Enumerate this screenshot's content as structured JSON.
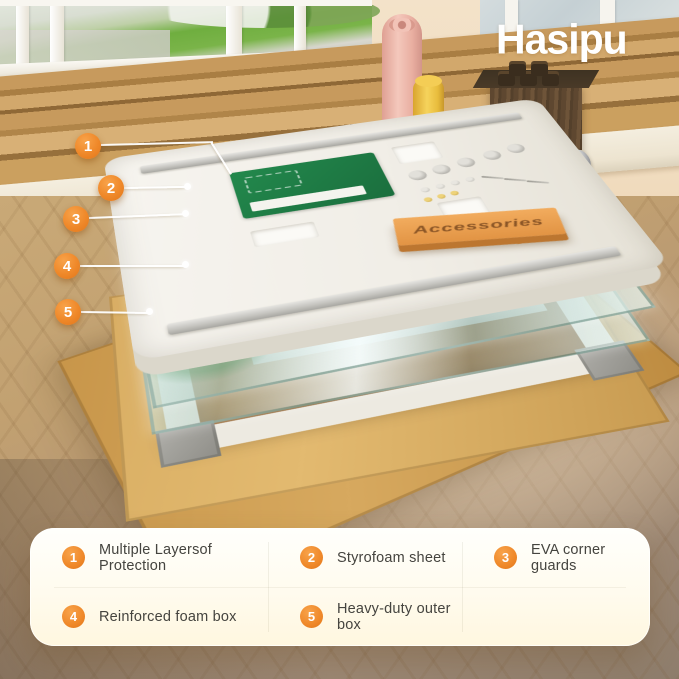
{
  "brand": {
    "logo_text": "Hasipu"
  },
  "hero": {
    "accessories_box_label": "Accessories",
    "callouts": [
      {
        "number": "1"
      },
      {
        "number": "2"
      },
      {
        "number": "3"
      },
      {
        "number": "4"
      },
      {
        "number": "5"
      }
    ]
  },
  "legend": {
    "items": [
      {
        "number": "1",
        "label": "Multiple Layersof Protection"
      },
      {
        "number": "2",
        "label": "Styrofoam sheet"
      },
      {
        "number": "3",
        "label": "EVA corner guards"
      },
      {
        "number": "4",
        "label": "Reinforced foam box"
      },
      {
        "number": "5",
        "label": "Heavy-duty outer box"
      }
    ]
  },
  "colors": {
    "accent_orange": "#EF8829",
    "panel_cream": "#FFFBEE",
    "cardboard": "#CFA258"
  }
}
